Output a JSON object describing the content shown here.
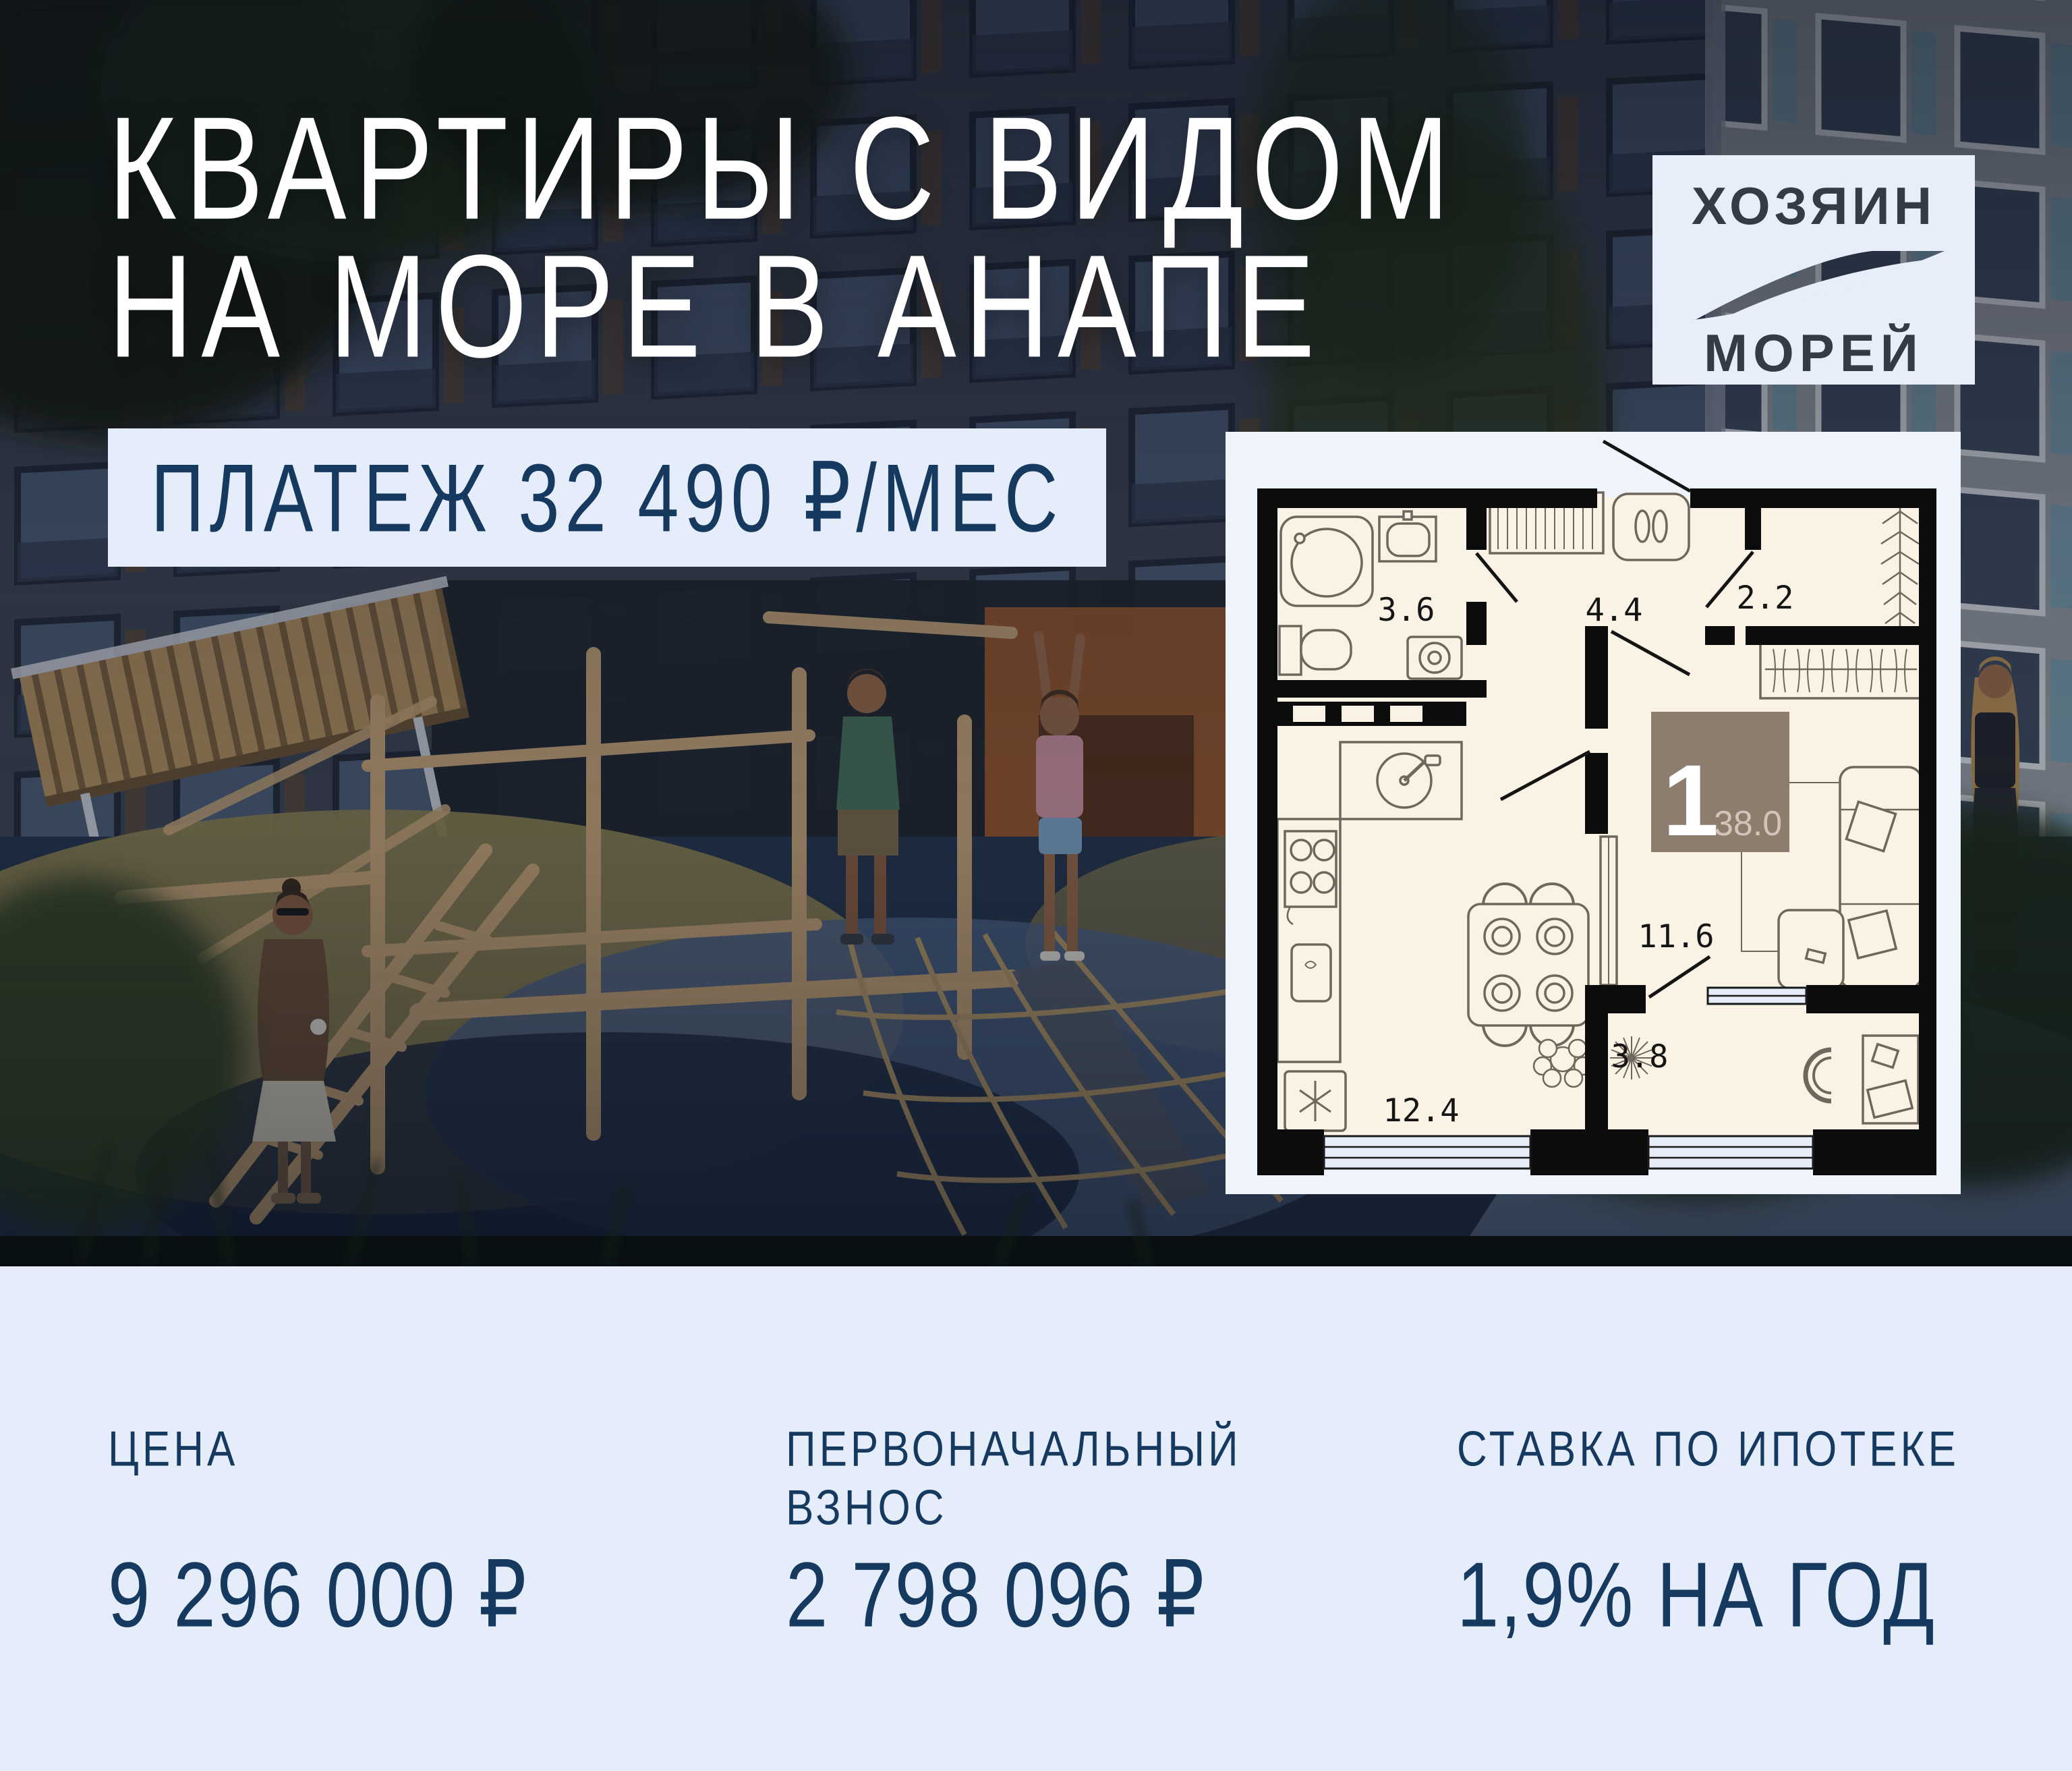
{
  "hero": {
    "headline_line1": "КВАРТИРЫ С ВИДОМ",
    "headline_line2": "НА МОРЕ В АНАПЕ",
    "payment_badge": "ПЛАТЕЖ 32 490 ₽/МЕС"
  },
  "logo": {
    "line1": "ХОЗЯИН",
    "line2": "МОРЕЙ"
  },
  "scene": {
    "entrance_number": "1"
  },
  "floor_plan": {
    "rooms": [
      {
        "name": "bathroom",
        "area": "3.6"
      },
      {
        "name": "hallway",
        "area": "4.4"
      },
      {
        "name": "wardrobe",
        "area": "2.2"
      },
      {
        "name": "living-room",
        "area": "11.6"
      },
      {
        "name": "loggia",
        "area": "3.8"
      },
      {
        "name": "kitchen",
        "area": "12.4"
      }
    ],
    "badge": {
      "rooms_count": "1",
      "total_area": "38.0"
    }
  },
  "stats": {
    "price": {
      "label": "ЦЕНА",
      "value": "9 296 000 ₽"
    },
    "down_payment": {
      "label": "ПЕРВОНАЧАЛЬНЫЙ ВЗНОС",
      "value": "2 798 096 ₽"
    },
    "mortgage_rate": {
      "label": "СТАВКА ПО ИПОТЕКЕ",
      "value": "1,9% НА ГОД"
    }
  },
  "colors": {
    "panel_bg": "#E6EDFA",
    "navy_text": "#16395F",
    "headline": "#FFFFFF",
    "plan_paper": "#FAF2E4",
    "plan_wall": "#0C0C0C",
    "plan_badge_brown": "#8C7D6F",
    "logo_bg": "#E7EDF9",
    "wood": "#C6A478"
  }
}
